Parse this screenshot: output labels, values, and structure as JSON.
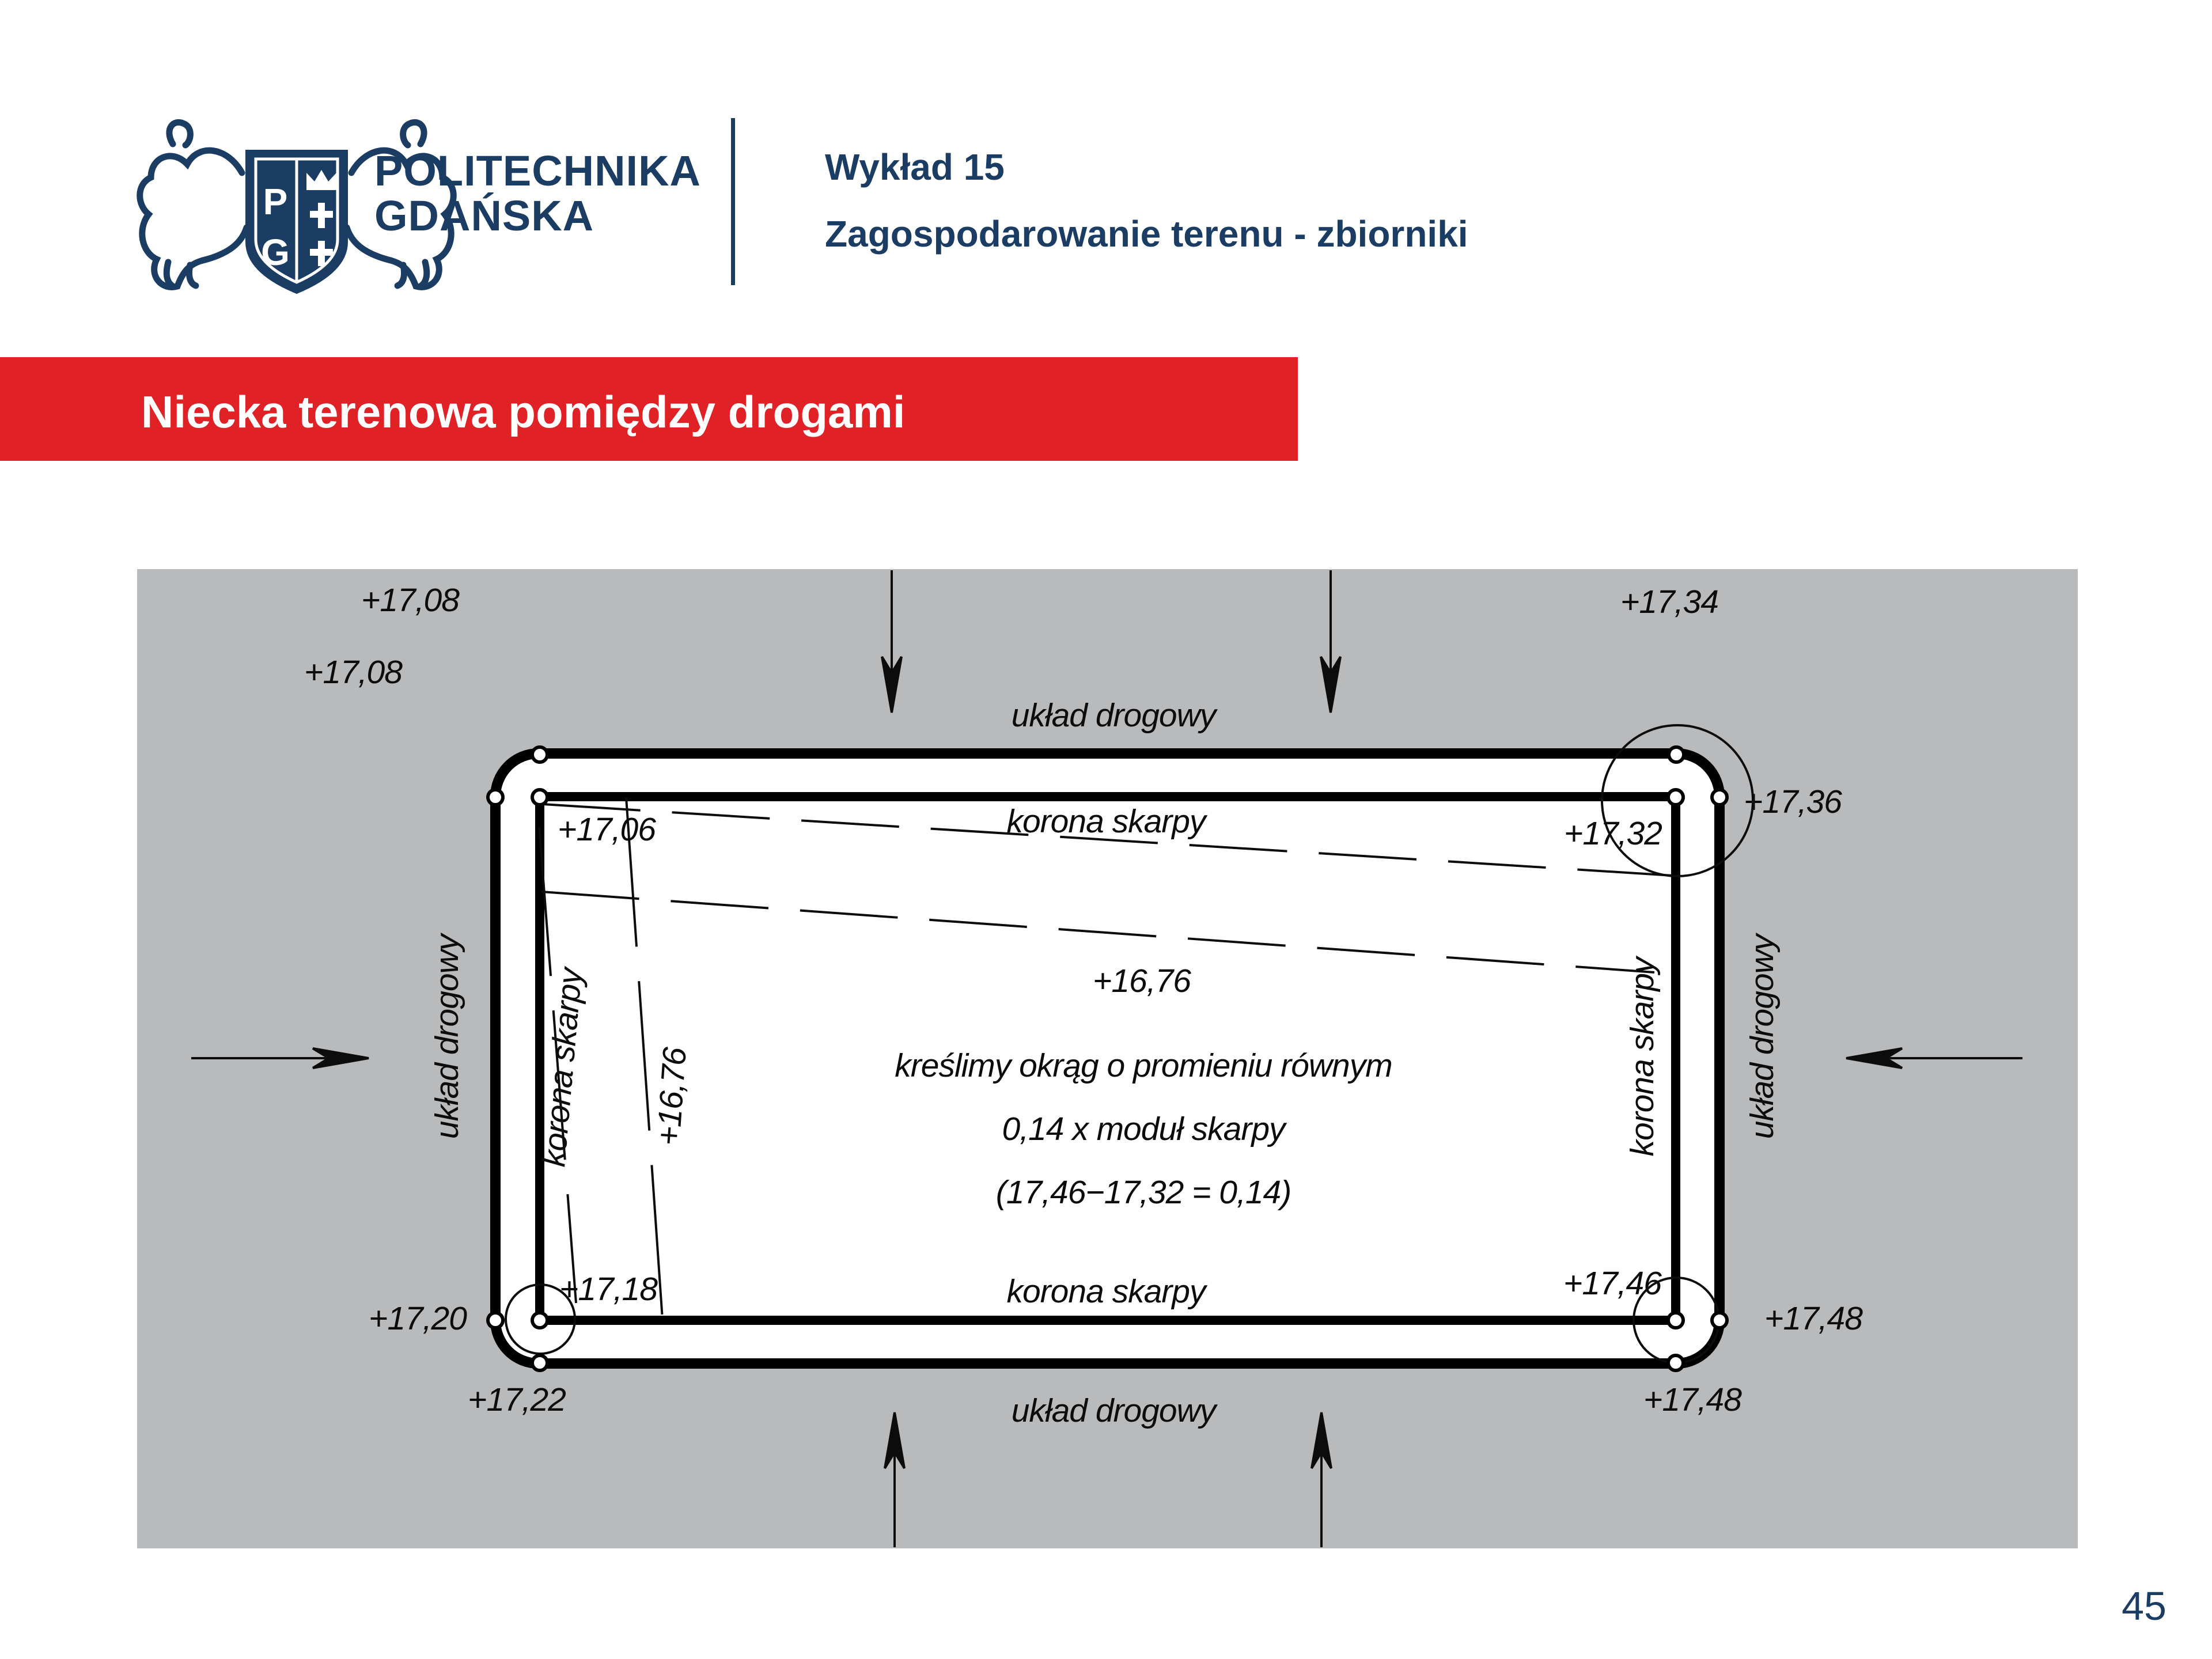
{
  "slide": {
    "logo": {
      "line1": "POLITECHNIKA",
      "line2": "GDAŃSKA"
    },
    "header": {
      "lecture": "Wykład 15",
      "topic": "Zagospodarowanie terenu - zbiorniki"
    },
    "banner_title": "Niecka terenowa pomiędzy drogami",
    "page_number": "45"
  },
  "colors": {
    "navy": "#1b3c63",
    "red": "#e02227",
    "gray": "#b9babc",
    "white": "#ffffff",
    "line": "#000000"
  },
  "diagram": {
    "labels": {
      "road_top": "układ drogowy",
      "road_bottom": "układ drogowy",
      "road_left": "układ drogowy",
      "road_right": "układ drogowy",
      "crest_top": "korona skarpy",
      "crest_bottom": "korona skarpy",
      "crest_left": "korona skarpy",
      "crest_right": "korona skarpy",
      "contour_center": "+16,76",
      "contour_left": "+16,76"
    },
    "elevations": {
      "tl_top": "+17,08",
      "tl_left": "+17,08",
      "tl_inner": "+17,06",
      "tr_top": "+17,34",
      "tr_right": "+17,36",
      "tr_inner": "+17,32",
      "bl_inner": "+17,18",
      "bl_left": "+17,20",
      "bl_bottom": "+17,22",
      "br_inner": "+17,46",
      "br_right": "+17,48",
      "br_bottom": "+17,48"
    },
    "note": {
      "line1": "kreślimy okrąg o promieniu równym",
      "line2": "0,14 x moduł skarpy",
      "line3": "(17,46−17,32 = 0,14)"
    }
  }
}
